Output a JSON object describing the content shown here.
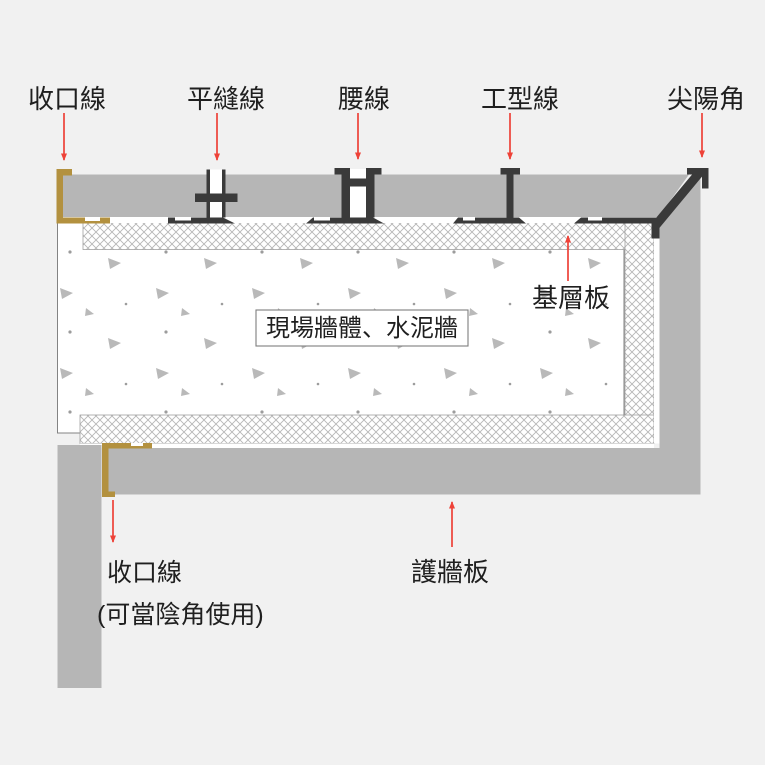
{
  "title": "牆板收邊線條剖面示意圖",
  "labels": {
    "closing_trim_top": "收口線",
    "flat_seam_trim": "平縫線",
    "waist_trim": "腰線",
    "i_type_trim": "工型線",
    "sharp_corner_trim": "尖陽角",
    "base_board": "基層板",
    "site_wall": "現場牆體、水泥牆",
    "closing_trim_bottom": "收口線",
    "closing_trim_bottom_note": "(可當陰角使用)",
    "wall_panel": "護牆板"
  },
  "colors": {
    "background": "#f1f1f1",
    "panel_gray": "#b6b6b6",
    "trim_dark": "#3a3a3a",
    "trim_bronze": "#b3913f",
    "arrow_red": "#ee4238",
    "hatch_line": "#b6b6b6",
    "concrete_speckle": "#b9b9b9",
    "label_text": "#1f1f1f",
    "outline_gray": "#838383"
  }
}
